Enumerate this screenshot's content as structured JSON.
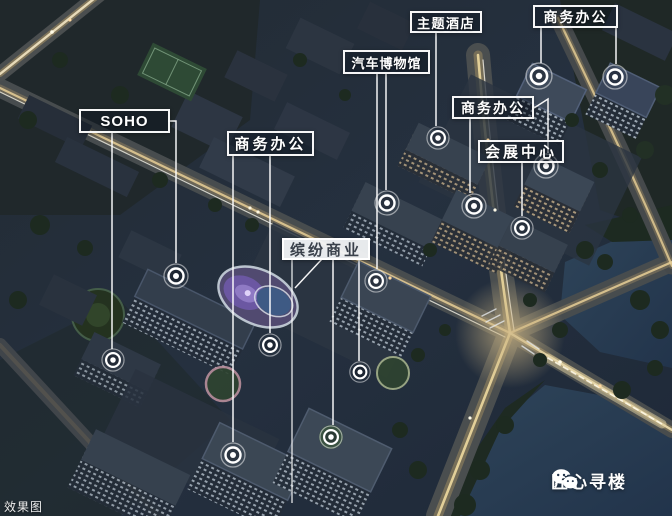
{
  "scene": {
    "description": "night aerial architectural rendering of a mixed-use development",
    "watermark": "效果图",
    "brand": {
      "name": "匠心寻楼",
      "icon": "wechat-icon"
    }
  },
  "labels": [
    {
      "id": "soho",
      "text": "SOHO"
    },
    {
      "id": "biz-mid-left",
      "text": "商务办公"
    },
    {
      "id": "car-museum",
      "text": "汽车博物馆"
    },
    {
      "id": "theme-hotel",
      "text": "主题酒店"
    },
    {
      "id": "biz-top-right",
      "text": "商务办公"
    },
    {
      "id": "biz-mid-right",
      "text": "商务办公"
    },
    {
      "id": "expo-center",
      "text": "会展中心"
    },
    {
      "id": "colorful-commerce",
      "text": "缤纷商业"
    }
  ],
  "colors": {
    "callout_border": "#ffffff",
    "callout_dark_bg": "rgba(14,21,33,0.46)",
    "callout_light_bg": "rgba(243,245,248,0.94)",
    "leader_line": "#ffffff",
    "night_base": "#232d3b",
    "water": "#2b4057",
    "road_glow": "#d9b778"
  }
}
